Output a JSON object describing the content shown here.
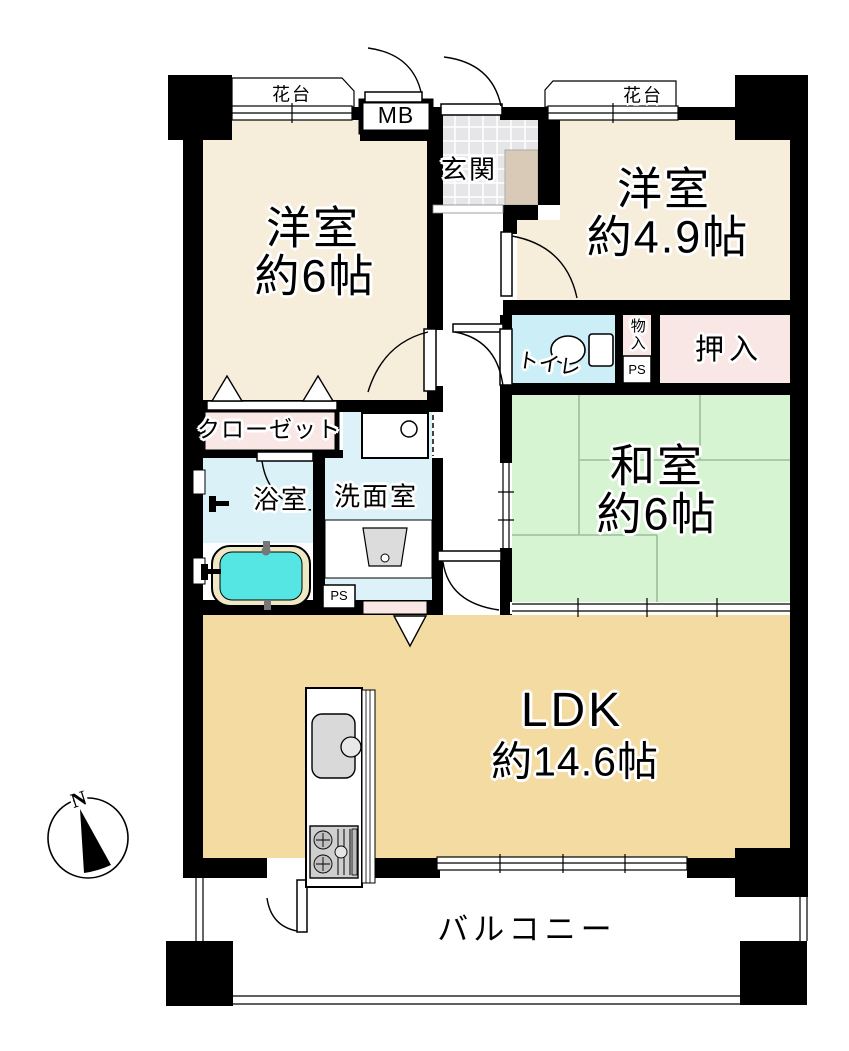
{
  "labels": {
    "hanadai_left": "花台",
    "mb": "MB",
    "genkan": "玄関",
    "hanadai_right": "花台",
    "yoshitsu6_name": "洋室",
    "yoshitsu6_size": "約6帖",
    "yoshitsu49_name": "洋室",
    "yoshitsu49_size": "約4.9帖",
    "toilet": "トイレ",
    "monoire": "物入",
    "ps_upper": "PS",
    "oshiire": "押入",
    "washitsu_name": "和室",
    "washitsu_size": "約6帖",
    "closet": "クローゼット",
    "bath": "浴室",
    "senmen": "洗面室",
    "ps_lower": "PS",
    "ldk_name": "LDK",
    "ldk_size": "約14.6帖",
    "balcony": "バルコニー",
    "compass_north": "N"
  },
  "colors": {
    "wall": "#000000",
    "room_western": "#f6eddb",
    "room_ldk": "#f3dba2",
    "room_japanese": "#d6f3d2",
    "closet_pink": "#f9e7e6",
    "toilet_blue": "#cbeef7",
    "bath_blue": "#d9f1f7",
    "washroom_blue": "#ddf2f8",
    "bathtub": "#55e6e3",
    "tub_rim": "#eee8c4",
    "entrance_tile": "#e6e6e9",
    "shoe_cabinet": "#d8cab6"
  }
}
